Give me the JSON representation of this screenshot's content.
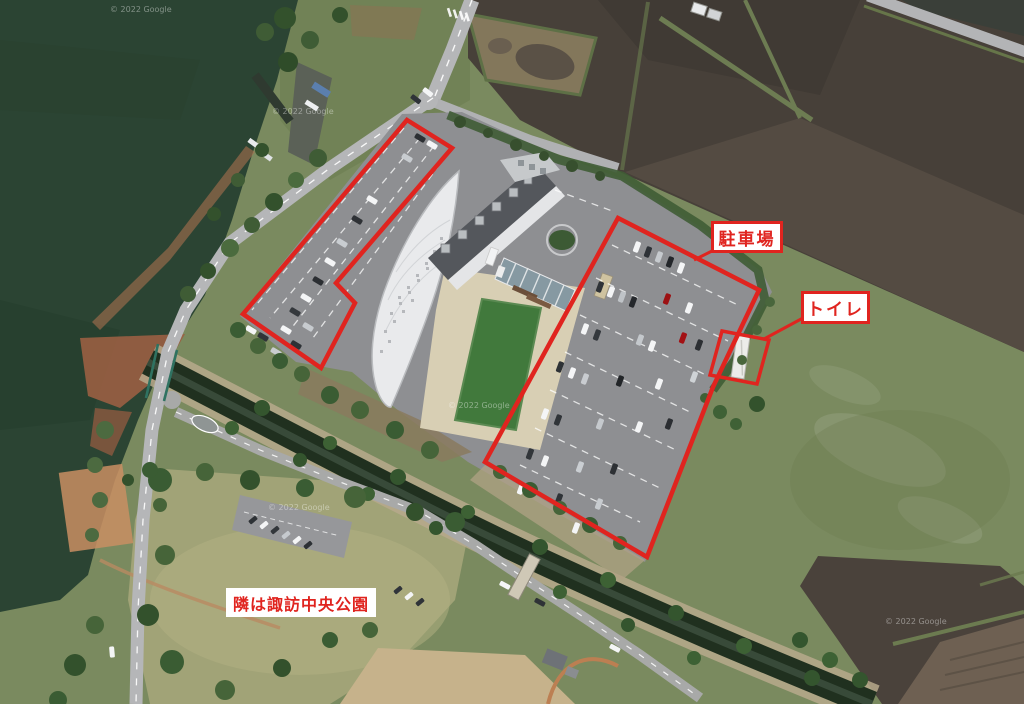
{
  "map": {
    "watermark": "© 2022 Google",
    "annotation_color": "#e0241f",
    "labels": {
      "parking": "駐車場",
      "toilet": "トイレ",
      "park_note": "隣は諏訪中央公園"
    },
    "colors": {
      "lake_water": "#2b4433",
      "canal_water": "#20301f",
      "field_dark": "#474039",
      "grass": "#7a8a5f",
      "courtyard_lawn": "#41793c",
      "parking_asphalt": "#8e8f92",
      "road": "#b5b6b8",
      "plaza": "#d8cfb4",
      "roof_white": "#e9eaec",
      "roof_dark": "#54575c"
    }
  }
}
